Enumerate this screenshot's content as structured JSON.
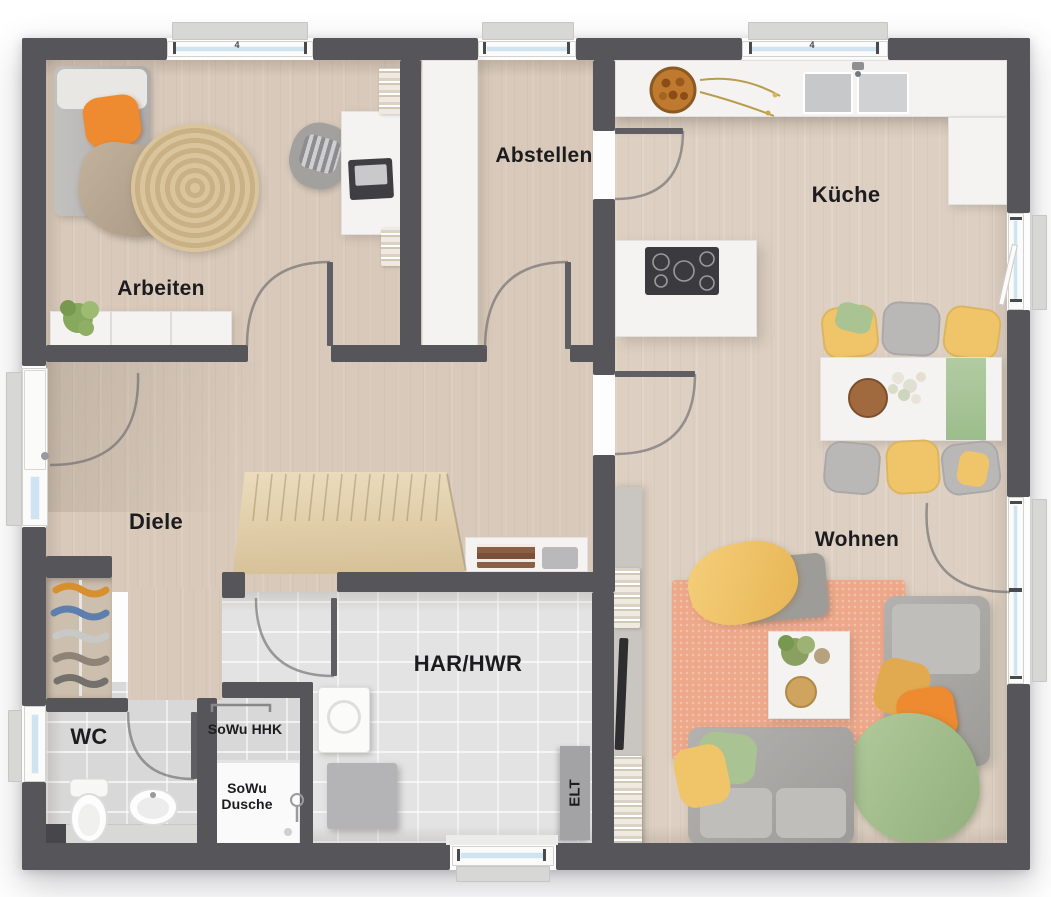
{
  "plan": {
    "room_labels": {
      "arbeiten": "Arbeiten",
      "abstellen": "Abstellen",
      "kueche": "Küche",
      "diele": "Diele",
      "wohnen": "Wohnen",
      "har_hwr": "HAR/HWR",
      "wc": "WC"
    },
    "annotations": {
      "sowu_hhk": "SoWu HHK",
      "sowu_dusche_line1": "SoWu",
      "sowu_dusche_line2": "Dusche",
      "elt": "ELT",
      "window_mark": "4"
    },
    "colors": {
      "wall": "#56565a",
      "wood_floor": "#d8c9ba",
      "tile_floor": "#e0e0e0",
      "counter_white": "#f4f3f1",
      "glass_blue": "#cfe4f0",
      "accent_orange": "#ee8a30",
      "accent_yellow": "#f0c469",
      "accent_green": "#a9c492",
      "rug_salmon": "#eda88a",
      "stairs_wood": "#e6d5b2",
      "sofa_gray": "#a6a4a1"
    }
  }
}
